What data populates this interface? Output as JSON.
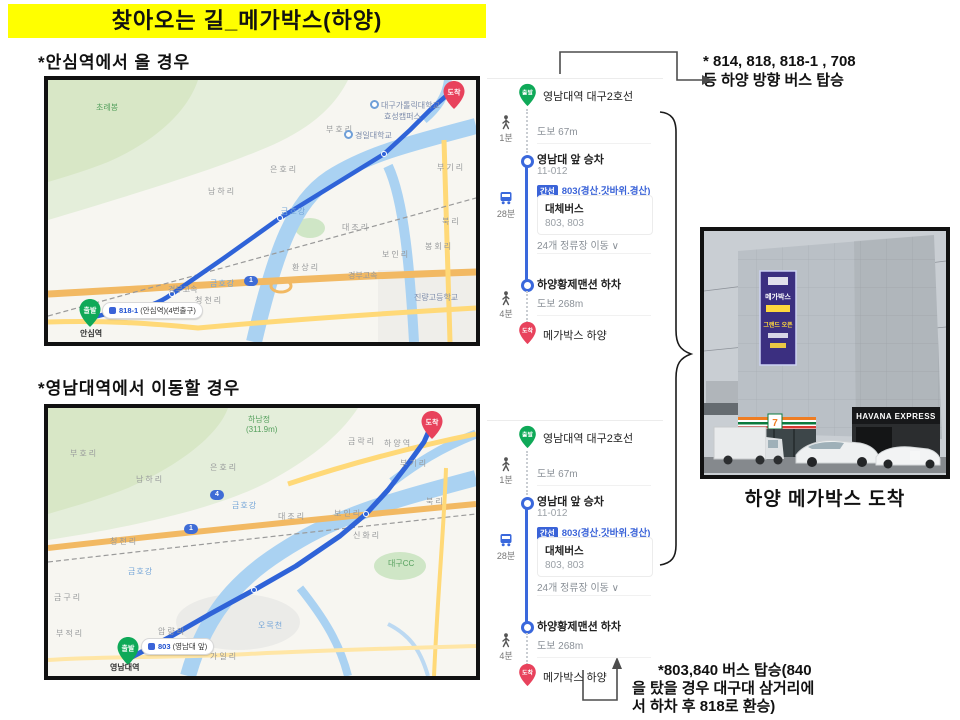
{
  "title": "찾아오는 길_메가박스(하양)",
  "sections": {
    "s1": "*안심역에서 올 경우",
    "s2": "*영남대역에서 이동할 경우"
  },
  "notes": {
    "top1": "* 814, 818, 818-1 , 708",
    "top2": "등 하양 방향 버스 탑승",
    "bottom1": "*803,840 버스 탑승(840",
    "bottom2": "을 탔을 경우 대구대 삼거리에",
    "bottom3": "서 하차 후 818로 환승)"
  },
  "route": {
    "start_badge": "출발",
    "start_station": "영남대역 대구2호선",
    "walk1_duration": "1분",
    "walk1_distance": "도보 67m",
    "board_stop": "영남대 앞 승차",
    "board_stop_id": "11-012",
    "bus_type_badge": "간선",
    "bus_line": "803(경산.갓바위.경산)",
    "bus_duration": "28분",
    "alt_bus_label": "대체버스",
    "alt_bus_lines": "803, 803",
    "stops_info": "24개 정류장 이동 ∨",
    "alight_stop": "하양황제맨션 하차",
    "walk2_duration": "4분",
    "walk2_distance": "도보 268m",
    "end_badge": "도착",
    "end_station": "메가박스 하양"
  },
  "map1": {
    "pin_start": "출발",
    "pin_end": "도착",
    "route_badge": "818-1",
    "route_badge_rest": "(안심역)(4번출구)",
    "station": "안심역",
    "labels": {
      "peak": "초례봉",
      "namha": "남하리",
      "eunho": "은호리",
      "buho": "부호리",
      "univ1a": "대구가톨릭대학교",
      "univ1b": "효성캠퍼스",
      "univ2": "경일대학교",
      "daejo": "대조리",
      "boin": "보인리",
      "hwansang": "환상리",
      "cheongcheon": "청천리",
      "bugi": "부기리",
      "buk": "북리",
      "bonghoe": "봉회리",
      "river1": "금호강",
      "river2": "금호강",
      "expwy1": "경부고속",
      "expwy2": "경부고속",
      "school": "진량고등학교",
      "shield1": "1"
    }
  },
  "map2": {
    "pin_start": "출발",
    "pin_end": "도착",
    "route_badge": "803",
    "route_badge_rest": "(영남대 앞)",
    "station": "영남대역",
    "labels": {
      "peak1": "하남정",
      "peak2": "(311.9m)",
      "namha": "남하리",
      "eunho": "은호리",
      "buho": "부호리",
      "cheongcheon": "청천리",
      "bugi": "부기리",
      "buk": "북리",
      "boin": "보인리",
      "geumnak": "금락리",
      "hayang_stn": "하양역",
      "shinhwa": "신화리",
      "daejo": "대조리",
      "amnyang": "압량리",
      "bujeok": "부적리",
      "gail": "가일리",
      "omok": "오목천",
      "golf": "대구CC",
      "geumgu": "금구리",
      "river1": "금호강",
      "river2": "금호강",
      "shield4": "4",
      "shield1": "1"
    }
  },
  "photo": {
    "caption": "하양 메가박스 도착",
    "sign": "HAVANA EXPRESS",
    "banner_line1": "메가박스",
    "banner_line2": "그랜드 오픈",
    "seven": "7"
  },
  "colors": {
    "highlight": "#ffff00",
    "transit_blue": "#3a68dc",
    "badge_blue": "#3a63d8",
    "start_green": "#0fa958",
    "end_red": "#e8425c",
    "route_blue": "#2f63d8",
    "river_blue": "#aad2f2",
    "road_orange": "#f2b963",
    "road_yellow": "#ffd978"
  }
}
